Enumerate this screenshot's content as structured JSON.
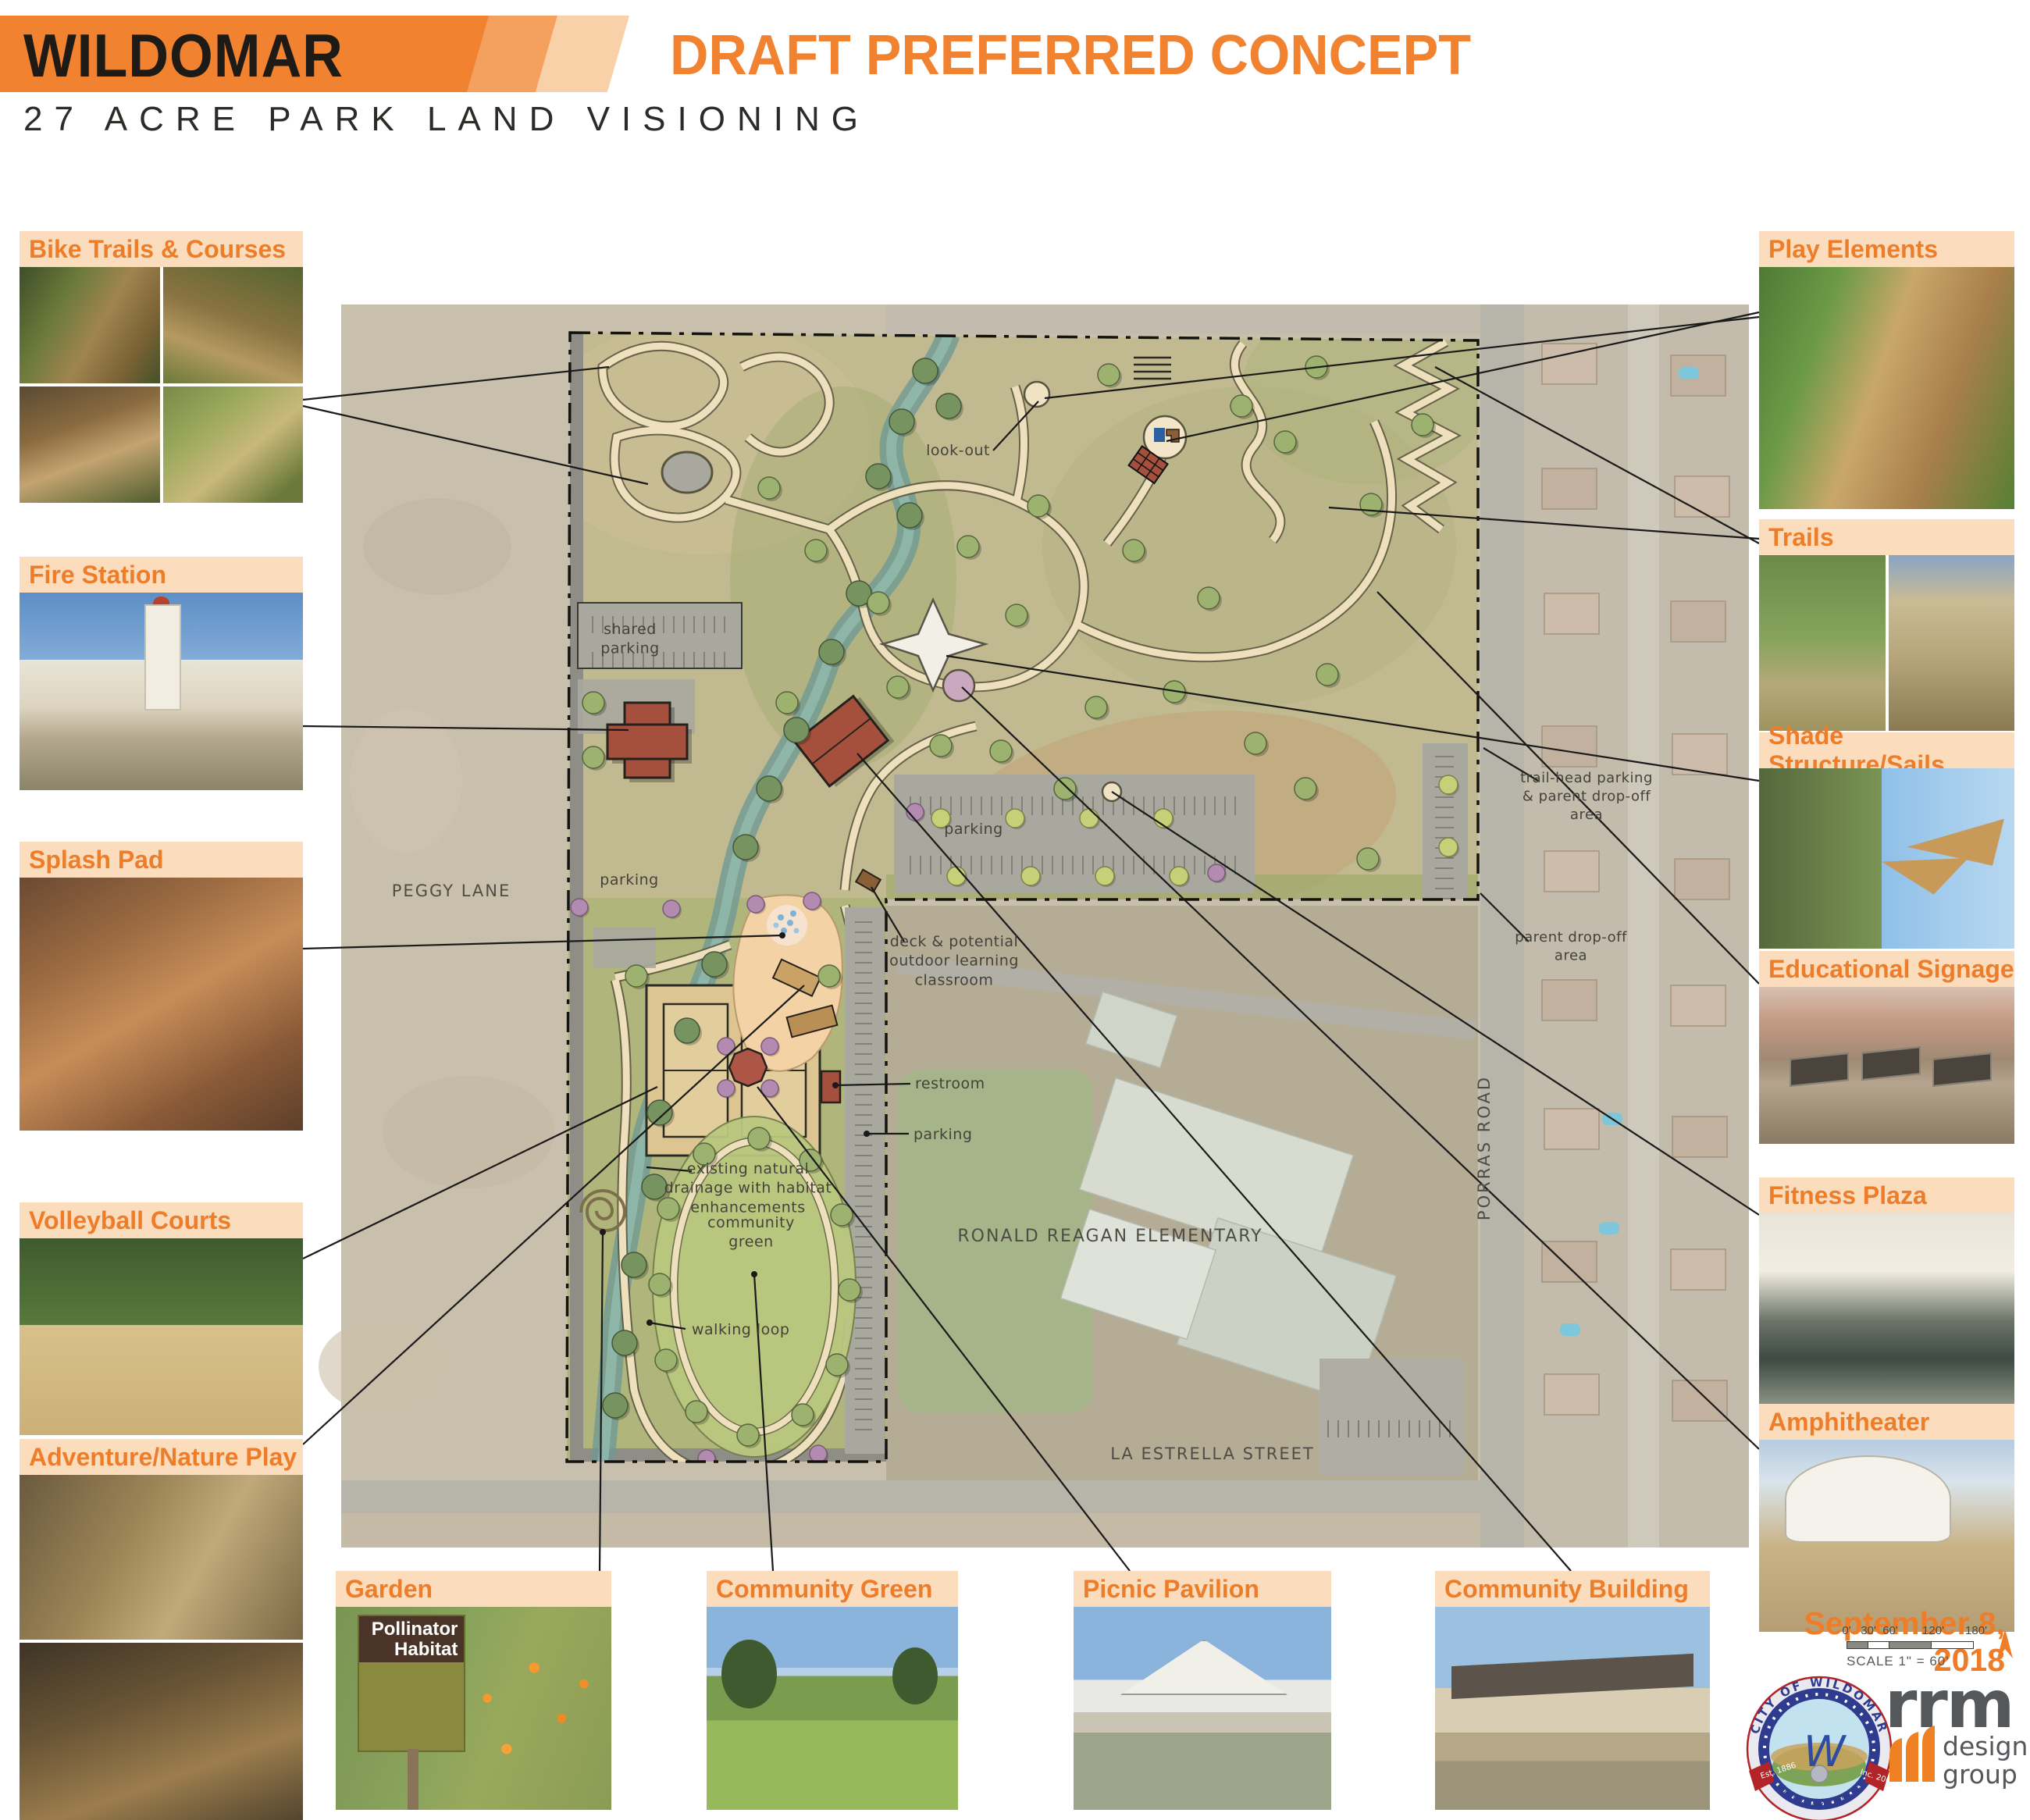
{
  "header": {
    "title": "WILDOMAR",
    "concept_label": "DRAFT PREFERRED CONCEPT",
    "subtitle": "27 ACRE PARK LAND VISIONING",
    "accent_color": "#F18230"
  },
  "cards": {
    "left": [
      {
        "label": "Bike Trails & Courses"
      },
      {
        "label": "Fire Station"
      },
      {
        "label": "Splash Pad"
      },
      {
        "label": "Volleyball Courts"
      },
      {
        "label": "Adventure/Nature Play"
      }
    ],
    "right": [
      {
        "label": "Play Elements"
      },
      {
        "label": "Trails"
      },
      {
        "label": "Shade Structure/Sails"
      },
      {
        "label": "Educational Signage"
      },
      {
        "label": "Fitness Plaza"
      },
      {
        "label": "Amphitheater"
      }
    ],
    "bottom": [
      {
        "label": "Garden"
      },
      {
        "label": "Community Green"
      },
      {
        "label": "Picnic Pavilion"
      },
      {
        "label": "Community Building"
      }
    ]
  },
  "garden_sign": {
    "line1": "Pollinator",
    "line2": "Habitat"
  },
  "map": {
    "labels": {
      "look_out": "look-out",
      "shared_parking": "shared\nparking",
      "parking_center": "parking",
      "parking_west": "parking",
      "peggy_lane": "PEGGY LANE",
      "deck": "deck & potential\noutdoor learning\nclassroom",
      "restroom": "restroom",
      "parking_south": "parking",
      "drainage": "existing natural\ndrainage with habitat\nenhancements",
      "community_green": "community\ngreen",
      "walking_loop": "walking loop",
      "school": "RONALD REAGAN ELEMENTARY",
      "la_estrella": "LA ESTRELLA STREET",
      "porras_road": "PORRAS ROAD",
      "trailhead": "trail-head parking\n& parent drop-off\narea",
      "parent_dropoff": "parent drop-off\narea"
    }
  },
  "footer": {
    "date": "September 8, 2018",
    "scale_note": "SCALE 1\" = 60'",
    "scale_ticks": [
      "0'",
      "30'",
      "60'",
      "120'",
      "180'"
    ]
  },
  "logos": {
    "seal_text": "CITY OF WILDOMAR",
    "seal_est": "Est. 1886",
    "seal_inc": "Inc. 2008",
    "seal_motto": "~ Opportunity ~ Progress",
    "seal_w": "W",
    "rrm": "rrm",
    "rrm_sub1": "design",
    "rrm_sub2": "group"
  }
}
